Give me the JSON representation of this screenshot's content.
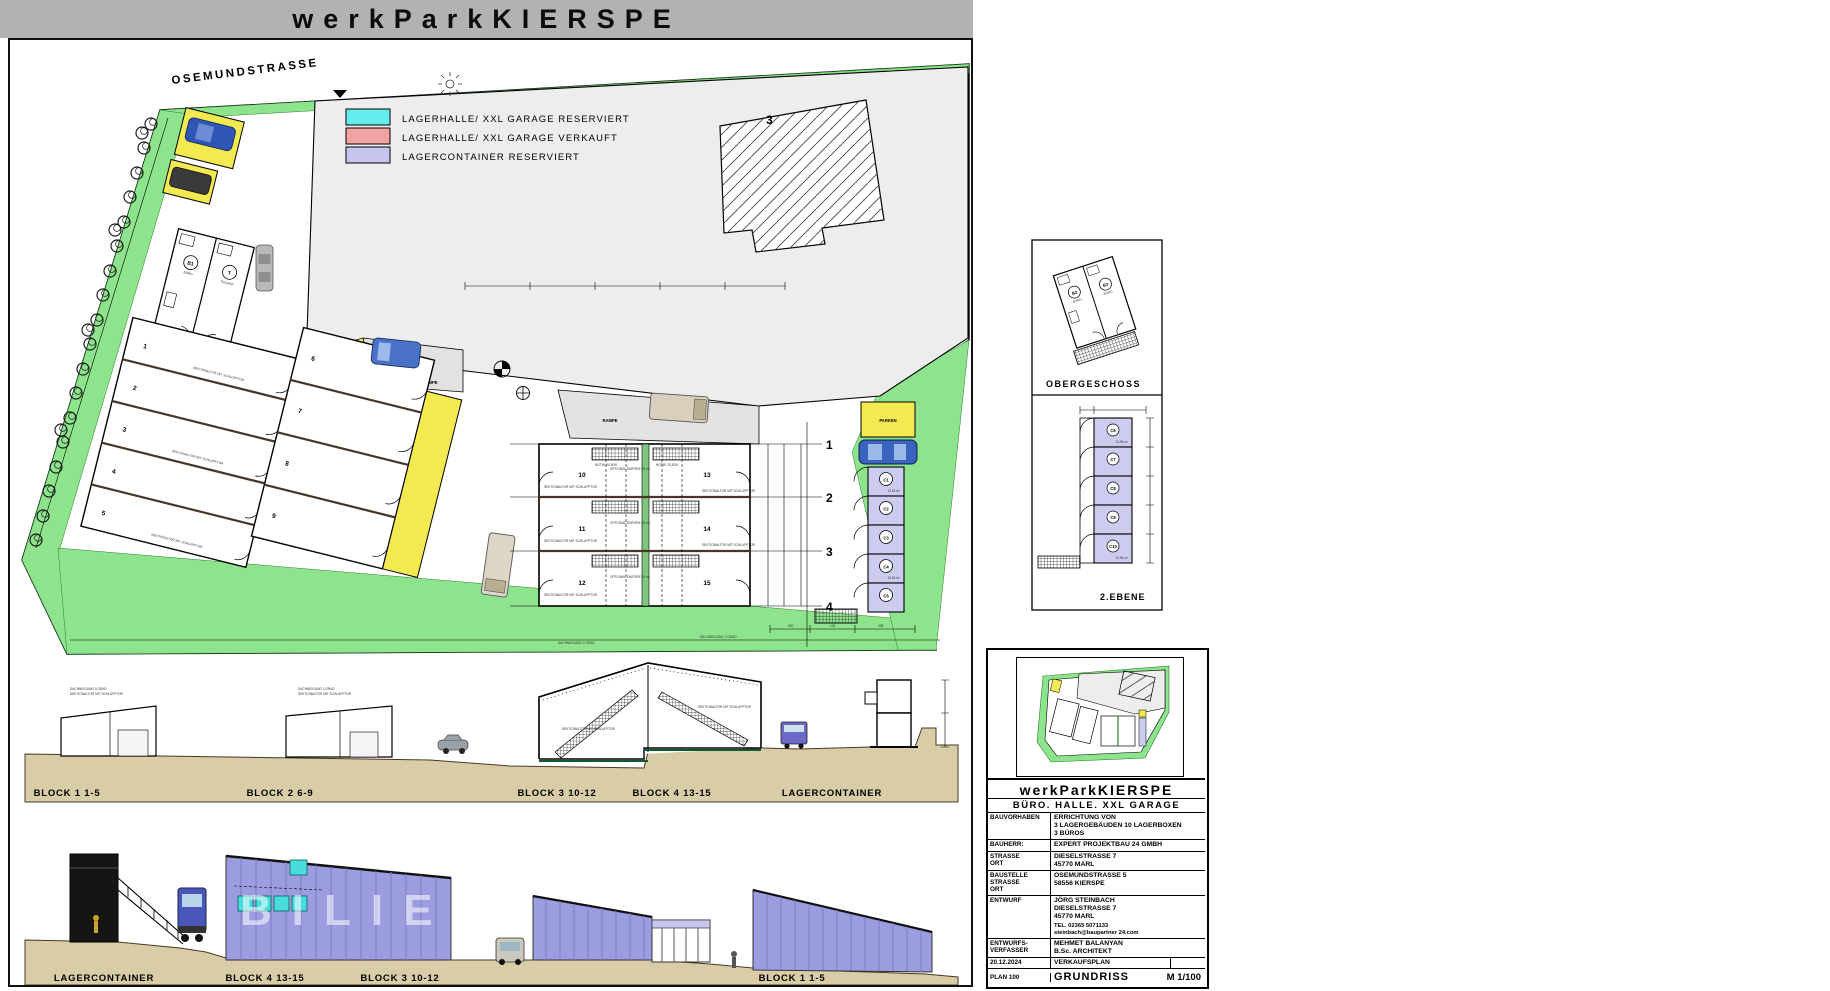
{
  "title_bar": {
    "title": "werkParkKIERSPE"
  },
  "plan": {
    "street": "OSEMUNDSTRASSE",
    "existing_building": "3",
    "legend": [
      {
        "label": "LAGERHALLE/ XXL GARAGE RESERVIERT",
        "color": "#63EDED"
      },
      {
        "label": "LAGERHALLE/ XXL GARAGE VERKAUFT",
        "color": "#F2A3A3"
      },
      {
        "label": "LAGERCONTAINER RESERVIERT",
        "color": "#C6C6EF"
      }
    ],
    "ramp": "RAMPE",
    "parken": "PARKEN",
    "grid_rows": [
      "1",
      "2",
      "3",
      "4"
    ],
    "units_b1": [
      "1",
      "2",
      "3",
      "4",
      "5"
    ],
    "units_b2": [
      "6",
      "7",
      "8",
      "9"
    ],
    "units_b34": [
      "10",
      "11",
      "12",
      "13",
      "14",
      "15"
    ],
    "containers": [
      "C1",
      "C2",
      "C3",
      "C4",
      "C5"
    ],
    "container_area": "13,94 m²",
    "office_b1": "B1",
    "office_t": "T",
    "office_buero": "BÜRO",
    "office_technik": "TECHNIK",
    "note_tor": "SEKTIONALTOR MIT SCHLUPFTÜR",
    "note_empore": "OPTIONAL EMPORE 15 m²",
    "note_stair": "NOTW. 20,5/26",
    "note_dach": "DACHNEIGUNG 3 GRAD",
    "dims": [
      "530",
      "130",
      "299"
    ]
  },
  "sections_upper": {
    "labels": [
      "BLOCK 1  1-5",
      "BLOCK 2  6-9",
      "BLOCK 3  10-12",
      "BLOCK 4  13-15",
      "LAGERCONTAINER"
    ]
  },
  "sections_lower": {
    "labels": [
      "LAGERCONTAINER",
      "BLOCK 4  13-15",
      "BLOCK 3  10-12",
      "BLOCK 2  6-9",
      "BLOCK 1  1-5"
    ],
    "watermark": "BILIEN"
  },
  "details": {
    "obergeschoss": "OBERGESCHOSS",
    "ebene": "2.EBENE",
    "office_units": [
      "B2",
      "B3"
    ],
    "office_buero": "BÜRO",
    "containers": [
      "C6",
      "C7",
      "C8",
      "C9",
      "C10"
    ],
    "area": "13,94 m²"
  },
  "title_block": {
    "project": "werkParkKIERSPE",
    "subtitle": "BÜRO. HALLE. XXL GARAGE",
    "bauvorhaben_label": "BAUVORHABEN",
    "bauvorhaben": [
      "ERRICHTUNG  VON",
      "3 LAGERGEBÄUDEN   10 LAGERBOXEN",
      "3 BÜROS"
    ],
    "bauherr_label": "BAUHERR:",
    "bauherr": "EXPERT PROJEKTBAU 24 GMBH",
    "strasse_label": [
      "STRASSE",
      "ORT"
    ],
    "strasse": [
      "DIESELSTRASSE 7",
      "45770 MARL"
    ],
    "baustelle_label": [
      "BAUSTELLE",
      "STRASSE",
      "ORT"
    ],
    "baustelle": [
      "OSEMUNDSTRASSE 5",
      "58556 KIERSPE"
    ],
    "entwurf_label": "ENTWURF",
    "entwurf": [
      "JÖRG STEINBACH",
      "DIESELSTRASSE 7",
      "45770 MARL"
    ],
    "entwurf_tel": "TEL. 02365 5071133",
    "entwurf_mail": "steinbach@baupartner 24.com",
    "verfasser_label": [
      "ENTWURFS-",
      "VERFASSER"
    ],
    "verfasser": [
      "MEHMET BALANYAN",
      "B.Sc. ARCHITEKT"
    ],
    "date": "20.12.2024",
    "date_value": "VERKAUFSPLAN",
    "plan_no": "PLAN 100",
    "plan_name": "GRUNDRISS",
    "scale": "M 1/100"
  }
}
